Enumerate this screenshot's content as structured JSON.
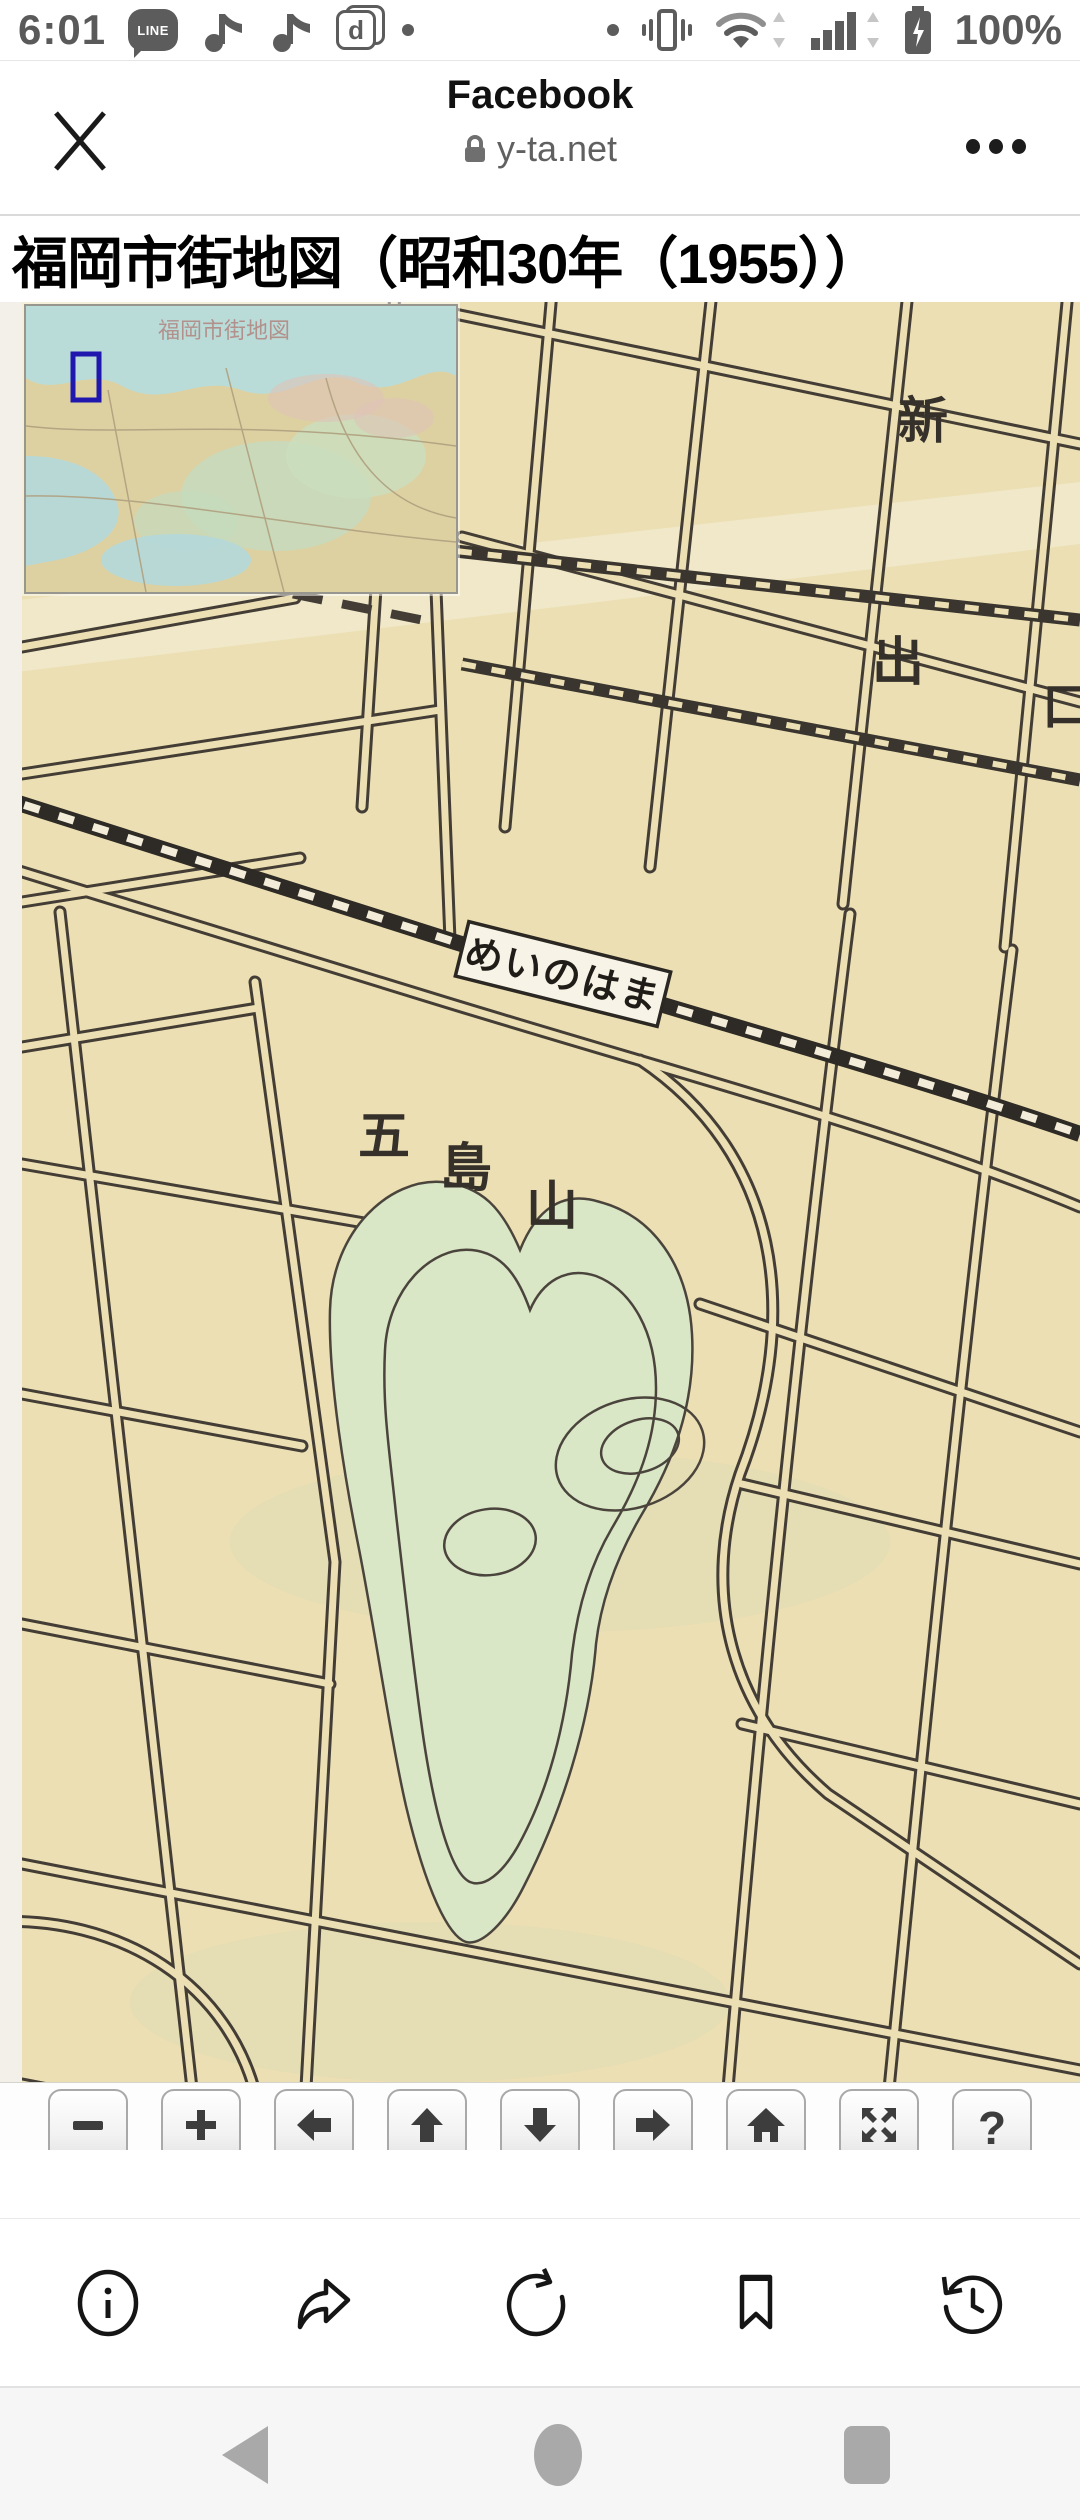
{
  "status_bar": {
    "time": "6:01",
    "battery_level": "100%",
    "line_logo": "LINE",
    "docomo_d": "d"
  },
  "browser_header": {
    "page_name": "Facebook",
    "domain": "y-ta.net"
  },
  "article": {
    "title": "福岡市街地図（昭和30年（1955））"
  },
  "map": {
    "inset_title": "福岡市街地図",
    "labels": {
      "district_shin": "新",
      "district_de": "出",
      "district_kuchi": "口",
      "station": "めいのはま",
      "hill_char1": "五",
      "hill_char2": "島",
      "hill_char3": "山"
    },
    "controls": {
      "zoom_out": "−",
      "zoom_in": "+",
      "help": "?"
    },
    "colors": {
      "paper": "#ebdfb3",
      "road_ink": "#433d35",
      "railway_ink": "#2e2a25",
      "hill_green": "#d9e7c6",
      "viewport_indicator": "#2018ae",
      "inset_sea": "#b9dcd8",
      "inset_land": "#ddd1a2"
    }
  }
}
